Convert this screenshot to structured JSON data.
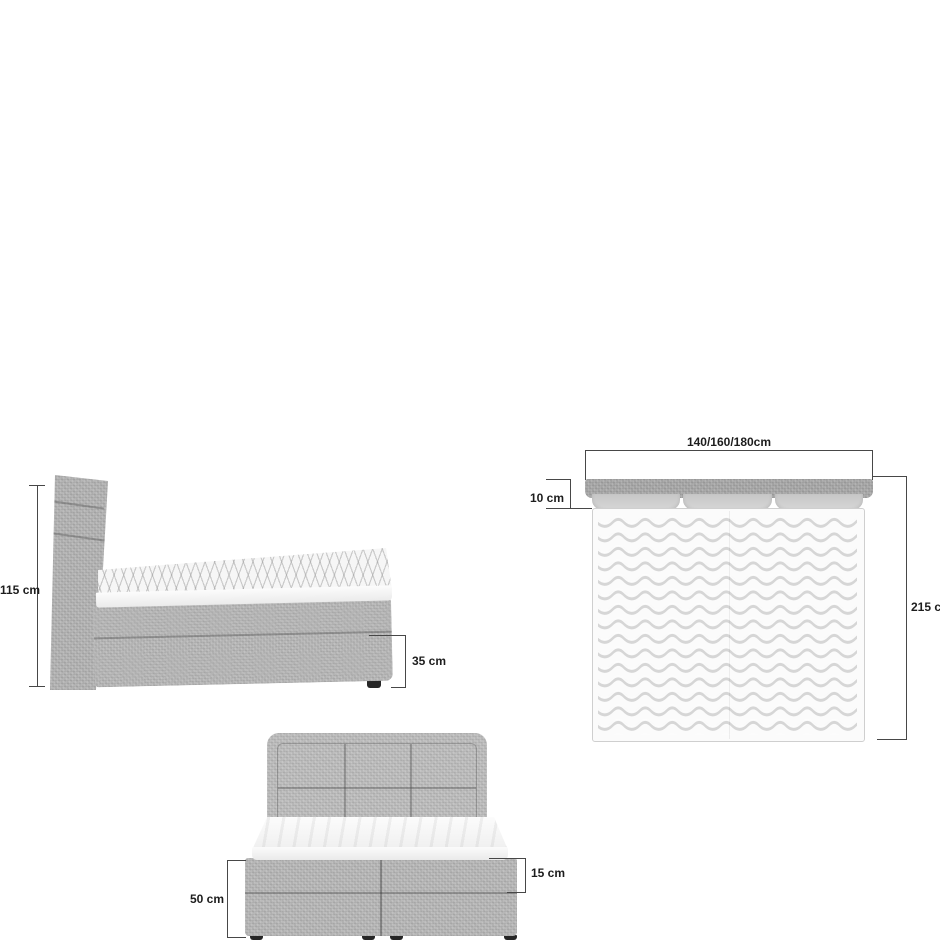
{
  "labels": {
    "side_height": "115 cm",
    "side_storage": "35 cm",
    "top_width": "140/160/180cm",
    "top_headboard_depth": "10 cm",
    "top_length": "215 cm",
    "front_base_height": "50 cm",
    "front_drawer_height": "15 cm"
  },
  "colors": {
    "background": "#ffffff",
    "fabric_gray": "#b6b6b6",
    "fabric_dark_gray": "#a6a6a6",
    "mattress_white": "#f8f8f8",
    "quilt_line": "#d6d6d6",
    "dimension_line": "#474747",
    "label_text": "#1d1d1d",
    "foot_black": "#262626"
  }
}
